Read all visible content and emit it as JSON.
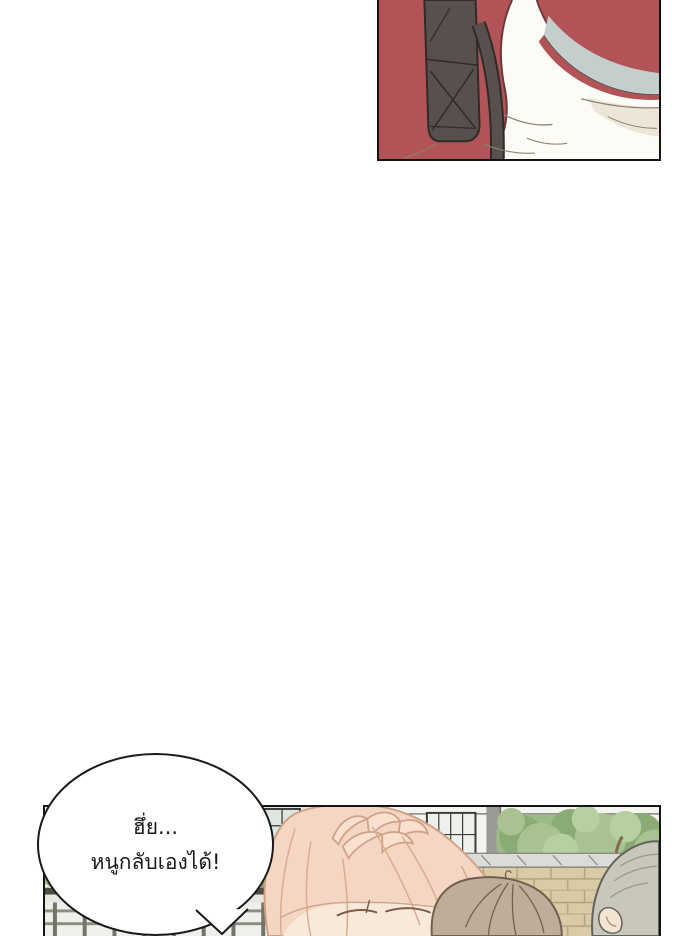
{
  "page": {
    "width": 700,
    "height": 936,
    "background": "#ffffff"
  },
  "comic": {
    "panels": [
      {
        "id": "panel-top",
        "description": "Close-up of a shoulder: dusty-red jacket, grey-blue collar lining, white shirt, dark grey bag strap with cross stitching hanging down",
        "border_color": "#141414"
      },
      {
        "id": "panel-bottom",
        "description": "Outdoor school scene: light building with dark-framed windows, green trees, grey pole, stone coping over a tan brick wall; pink-haired girl up close with hand on head and closed eyes, brown-haired head and grey-haired person seen from behind",
        "border_color": "#141414"
      }
    ],
    "speech_bubble": {
      "shape": "ellipse",
      "fill": "#ffffff",
      "border_color": "#1a1a1a",
      "text_color": "#1a1a1a",
      "lines": [
        "ฮึ่ย...",
        "หนูกลับเองได้!"
      ]
    },
    "palette": {
      "jacket_red": "#b25457",
      "jacket_edge": "#6d383a",
      "strap_dark": "#57504d",
      "strap_line": "#2f2b29",
      "collar_bluegray": "#c3cecd",
      "shirt_white": "#fcfbf6",
      "shirt_shadow": "#ece6d9",
      "hair_pink": "#f5d6c3",
      "hair_pink_outline": "#cfa288",
      "skin": "#f9e9da",
      "hair_brown": "#c0ad99",
      "hair_brown_outline": "#6f6053",
      "hair_gray": "#c9c6bb",
      "hair_gray_outline": "#63635d",
      "tree_green": "#9cba86",
      "brick_tan": "#d9cba6",
      "brick_line": "#b2a27e",
      "wall_light": "#f3f4f0",
      "pole_gray": "#9a9a96"
    }
  }
}
